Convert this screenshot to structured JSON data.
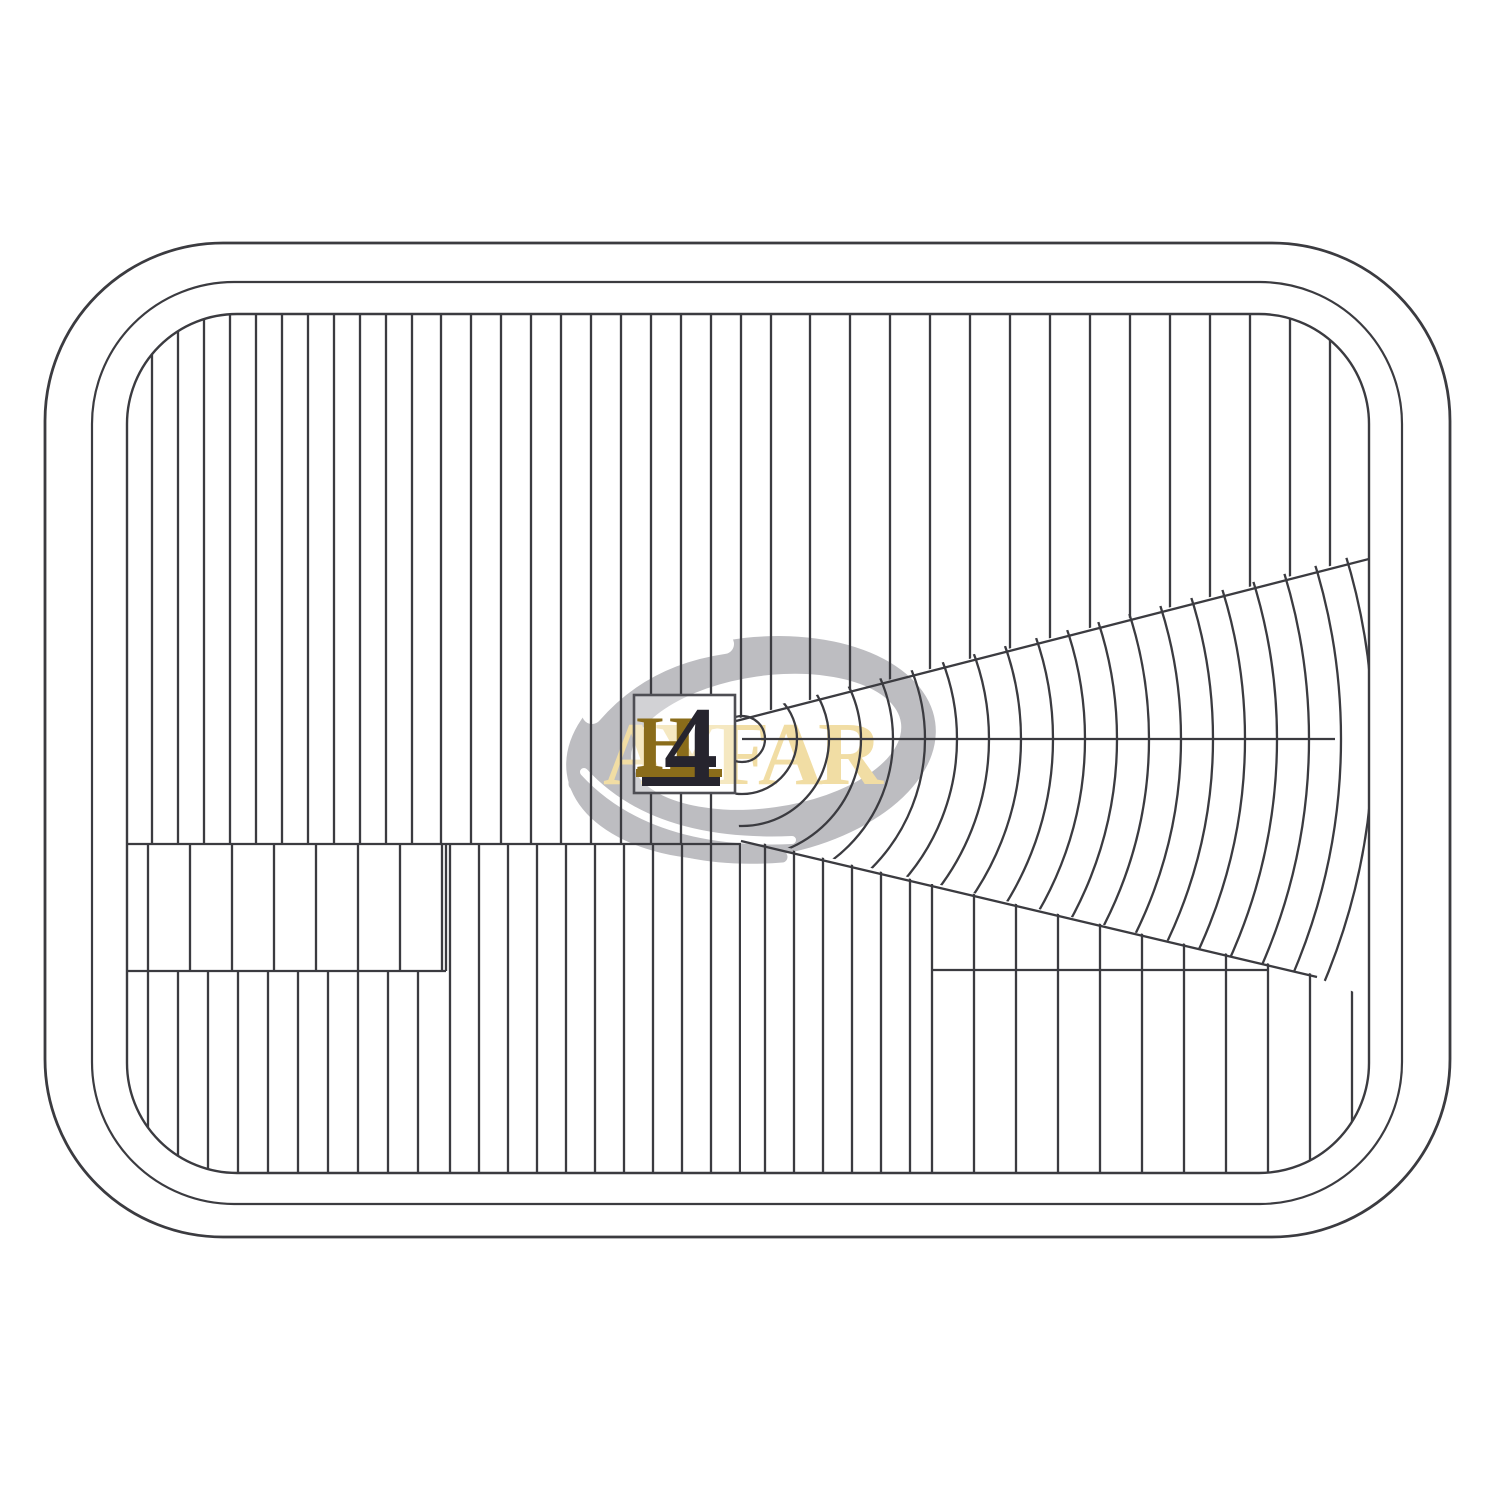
{
  "figure": {
    "marking_parts": [
      "H",
      "4"
    ],
    "watermark_text": "AYFAR"
  },
  "palette": {
    "background": "#ffffff",
    "line": "#3b3b40",
    "logo_gray": "#bdbdc1",
    "logo_beige": "#f1dda4",
    "marking_gold": "#8a6c1a",
    "marking_dark": "#26242e",
    "box_border": "#4e4e54",
    "box_fill": "rgba(255,255,255,0.32)"
  },
  "geometry": {
    "outer": {
      "x": 45,
      "y": 243,
      "w": 1405,
      "h": 994,
      "rad": 178,
      "sw": 2.8
    },
    "middle": {
      "x": 92,
      "y": 282,
      "w": 1310,
      "h": 922,
      "rad": 142,
      "sw": 2.2
    },
    "inner": {
      "x": 127,
      "y": 314,
      "w": 1242,
      "h": 859,
      "rad": 110,
      "sw": 2.4
    },
    "box": {
      "x": 634,
      "y": 695,
      "w": 101,
      "h": 98
    },
    "logo": {
      "cx": 751,
      "cy": 748,
      "rotate": -8,
      "outer_rx": 186,
      "outer_ry": 110,
      "hole_cx": 767,
      "hole_cy": 744,
      "hole_rx": 136,
      "hole_ry": 66,
      "strokes": [
        {
          "d": "M 592 714 Q 642 656 724 644",
          "color": "#ffffff",
          "w": 20
        },
        {
          "d": "M 574 784 Q 642 868 782 857",
          "color": "#bdbdc1",
          "w": 11
        },
        {
          "d": "M 584 772 Q 652 846 792 840",
          "color": "#ffffff",
          "w": 8
        }
      ]
    },
    "rib_sw": 2.3,
    "rib_regions": [
      {
        "clip": [
          [
            127,
            314
          ],
          [
            1369,
            314
          ],
          [
            1369,
            556
          ],
          [
            736,
            719
          ],
          [
            736,
            844
          ],
          [
            127,
            844
          ]
        ],
        "bands": [
          {
            "x0": 152,
            "step": 26,
            "x1": 419
          },
          {
            "x0": 441,
            "step": 30,
            "x1": 779
          },
          {
            "x0": 810,
            "step": 40,
            "x1": 1350
          }
        ]
      },
      {
        "clip": [
          [
            127,
            844
          ],
          [
            446,
            844
          ],
          [
            446,
            971
          ],
          [
            127,
            971
          ]
        ],
        "bands": [
          {
            "x0": 148,
            "step": 42,
            "x1": 445
          }
        ]
      },
      {
        "clip": [
          [
            127,
            971
          ],
          [
            446,
            971
          ],
          [
            446,
            1173
          ],
          [
            127,
            1173
          ]
        ],
        "bands": [
          {
            "x0": 148,
            "step": 30,
            "x1": 445
          }
        ]
      },
      {
        "clip": [
          [
            446,
            844
          ],
          [
            741,
            844
          ],
          [
            741,
            1173
          ],
          [
            446,
            1173
          ]
        ],
        "bands": [
          {
            "x0": 450,
            "step": 29,
            "x1": 741
          }
        ]
      },
      {
        "clip": [
          [
            741,
            838
          ],
          [
            932,
            884
          ],
          [
            932,
            1173
          ],
          [
            741,
            1173
          ]
        ],
        "bands": [
          {
            "x0": 765,
            "step": 29,
            "x1": 930
          }
        ]
      },
      {
        "clip": [
          [
            932,
            884
          ],
          [
            1317,
            975
          ],
          [
            1369,
            999
          ],
          [
            1369,
            1173
          ],
          [
            932,
            1173
          ]
        ],
        "bands": [
          {
            "x0": 974,
            "step": 42,
            "x1": 1360
          }
        ]
      }
    ],
    "fan": {
      "cx": 742,
      "cy": 739,
      "radii": [
        23,
        55,
        87,
        119,
        151,
        183,
        215,
        247,
        279,
        311,
        343,
        375,
        407,
        439,
        471,
        503,
        535,
        567,
        599,
        631
      ],
      "wedge": [
        [
          735,
          716
        ],
        [
          1369,
          552
        ],
        [
          1369,
          1003
        ],
        [
          1317,
          977
        ],
        [
          740,
          836
        ],
        [
          735,
          791
        ]
      ]
    },
    "lines": [
      [
        127,
        844,
        741,
        844
      ],
      [
        127,
        971,
        446,
        971
      ],
      [
        932,
        970,
        1268,
        970
      ],
      [
        446,
        844,
        446,
        971
      ],
      [
        932,
        884,
        932,
        1173
      ],
      [
        736,
        721,
        1369,
        559
      ],
      [
        741,
        841,
        1317,
        977
      ],
      [
        742,
        739,
        1335,
        739
      ]
    ],
    "marking": {
      "h_x": 636,
      "h_y": 770,
      "four_x": 664,
      "four_y": 781,
      "underline_gold": {
        "x": 636,
        "y": 769,
        "w": 86,
        "h": 8
      },
      "underline_dark": {
        "x": 642,
        "y": 777,
        "w": 78,
        "h": 9
      }
    },
    "watermark": {
      "x": 603,
      "y": 784
    }
  }
}
